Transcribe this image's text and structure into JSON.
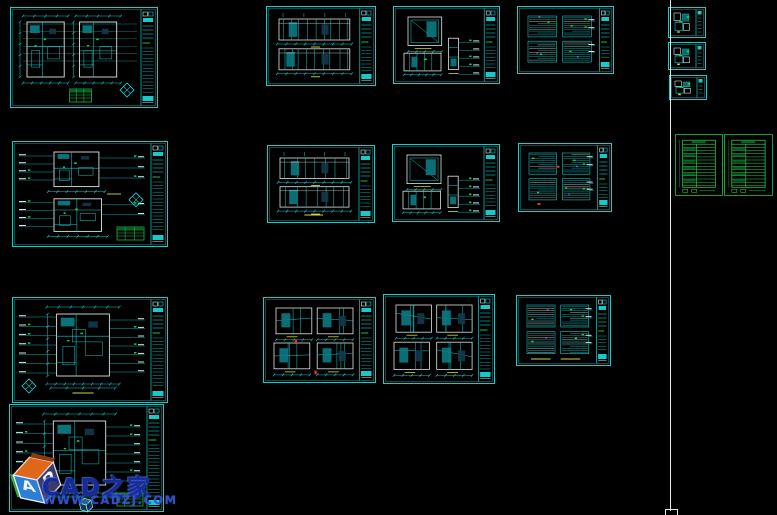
{
  "app": {
    "view": "cad-model-space"
  },
  "colors": {
    "background": "#000000",
    "sheet_border": "#12cfcf",
    "line_cyan": "#17c9c9",
    "line_white": "#dfe3e3",
    "line_green": "#1fd24a",
    "line_yellow": "#d6d63c",
    "line_magenta": "#c93ec9",
    "line_red": "#d8401c",
    "fill_teal": "#0b7a84",
    "fill_dark": "#123a4a",
    "table_border": "#12a035",
    "table_line": "#2ce052",
    "table_fill": "#0c5f24",
    "divider": "#e8e8e8"
  },
  "divider": {
    "x": 670,
    "top": 0,
    "bottom": 511,
    "grip": {
      "x": 665,
      "y": 509,
      "w": 11,
      "h": 5
    }
  },
  "watermark": {
    "brand": "CAD之家",
    "url": "WWW.CADZJ.COM",
    "logo": "cad-cube-logo",
    "letter_a": "A",
    "letter_d": "D"
  },
  "sheets": [
    {
      "id": "floor-plan-pair-sheet",
      "kind": "plan-two-col",
      "x": 10,
      "y": 7,
      "w": 148,
      "h": 101,
      "diamond": "br",
      "table": "bc"
    },
    {
      "id": "elevation-sheet-1",
      "kind": "elevation-pair",
      "x": 266,
      "y": 6,
      "w": 110,
      "h": 80
    },
    {
      "id": "elevation-sheet-2",
      "kind": "elevation-mixed",
      "x": 393,
      "y": 6,
      "w": 107,
      "h": 78
    },
    {
      "id": "detail-sheet-1",
      "kind": "detail-grid",
      "x": 517,
      "y": 6,
      "w": 97,
      "h": 68
    },
    {
      "id": "small-detail-sheet-1",
      "kind": "small-detail",
      "x": 668,
      "y": 7,
      "w": 38,
      "h": 31
    },
    {
      "id": "small-detail-sheet-2",
      "kind": "small-detail",
      "x": 668,
      "y": 42,
      "w": 38,
      "h": 28
    },
    {
      "id": "small-detail-sheet-3",
      "kind": "small-detail",
      "x": 669,
      "y": 75,
      "w": 38,
      "h": 25
    },
    {
      "id": "floor-plan-stack-sheet",
      "kind": "plan-stack",
      "x": 12,
      "y": 141,
      "w": 156,
      "h": 106,
      "diamond": "mr",
      "table": "br",
      "yellow": true
    },
    {
      "id": "elevation-sheet-3",
      "kind": "elevation-pair",
      "x": 267,
      "y": 145,
      "w": 108,
      "h": 78,
      "underline": true
    },
    {
      "id": "elevation-sheet-4",
      "kind": "elevation-mixed",
      "x": 392,
      "y": 144,
      "w": 108,
      "h": 78
    },
    {
      "id": "detail-sheet-2",
      "kind": "detail-grid",
      "x": 518,
      "y": 143,
      "w": 94,
      "h": 69,
      "red": true
    },
    {
      "id": "schedule-table-sheet-1",
      "kind": "table",
      "x": 675,
      "y": 134,
      "w": 48,
      "h": 62
    },
    {
      "id": "schedule-table-sheet-2",
      "kind": "table",
      "x": 724,
      "y": 134,
      "w": 49,
      "h": 62
    },
    {
      "id": "single-floor-plan-sheet-1",
      "kind": "single-plan",
      "x": 12,
      "y": 297,
      "w": 156,
      "h": 106,
      "diamond": "bl",
      "underline": true
    },
    {
      "id": "elevation-sheet-5",
      "kind": "elevation-grid",
      "x": 263,
      "y": 297,
      "w": 113,
      "h": 86,
      "red": true
    },
    {
      "id": "elevation-sheet-6",
      "kind": "elevation-grid",
      "x": 383,
      "y": 294,
      "w": 112,
      "h": 90
    },
    {
      "id": "detail-sheet-3",
      "kind": "detail-grid",
      "x": 516,
      "y": 295,
      "w": 95,
      "h": 71,
      "underline": true
    },
    {
      "id": "single-floor-plan-sheet-2",
      "kind": "single-plan",
      "x": 9,
      "y": 404,
      "w": 155,
      "h": 108,
      "table": "br"
    }
  ]
}
